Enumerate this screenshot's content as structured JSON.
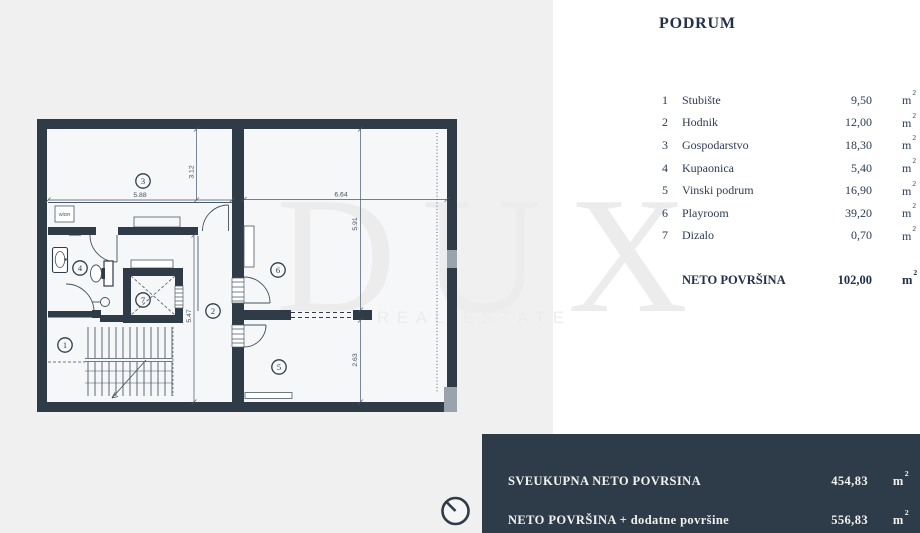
{
  "title": "PODRUM",
  "units": {
    "base": "m",
    "sup": "2"
  },
  "legend": {
    "rows": [
      {
        "num": "1",
        "name": "Stubište",
        "area": "9,50"
      },
      {
        "num": "2",
        "name": "Hodnik",
        "area": "12,00"
      },
      {
        "num": "3",
        "name": "Gospodarstvo",
        "area": "18,30"
      },
      {
        "num": "4",
        "name": "Kupaonica",
        "area": "5,40"
      },
      {
        "num": "5",
        "name": "Vinski podrum",
        "area": "16,90"
      },
      {
        "num": "6",
        "name": "Playroom",
        "area": "39,20"
      },
      {
        "num": "7",
        "name": "Dizalo",
        "area": "0,70"
      }
    ],
    "total": {
      "label": "NETO POVRŠINA",
      "value": "102,00"
    }
  },
  "summary": {
    "rows": [
      {
        "label": "SVEUKUPNA NETO POVRSINA",
        "value": "454,83"
      },
      {
        "label": "NETO POVRŠINA + dodatne površine",
        "value": "556,83"
      }
    ]
  },
  "watermark": {
    "line1": "DUX",
    "line2": "REAL ESTATE"
  },
  "plan": {
    "floor_label": "W/DR",
    "dimensions": {
      "room3_width": "5.88",
      "room3_height": "3.12",
      "room6_width": "6.64",
      "room6_height": "5.91",
      "corridor_height": "5.47",
      "room5_height": "2.63"
    }
  },
  "colors": {
    "wall": "#2f3b47",
    "summary_panel": "#2e3c4a",
    "legend_text": "#2c3b52",
    "background": "#f0f0f1"
  }
}
